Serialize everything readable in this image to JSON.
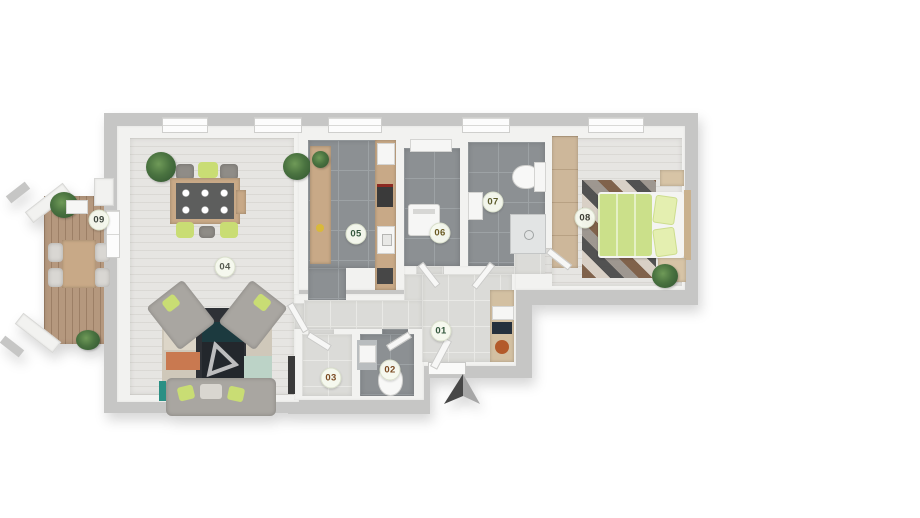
{
  "meta": {
    "type": "floor-plan",
    "description": "3D rendered apartment floor plan viewed from above with numbered room markers"
  },
  "palette": {
    "exterior_wall": "#c6c6c5",
    "interior_wall": "#f2f2f0",
    "dark_tile": "#8c9093",
    "light_tile": "#dbdbd8",
    "light_wood": "#e6e5e2",
    "deck_wood": "#b5987e",
    "accent_lime": "#c9dd74",
    "bed_green": "#cbe08a",
    "badge_bg": "#f6f9ee"
  },
  "rooms": [
    {
      "id": "01",
      "label": "01",
      "label_color": "#33573d"
    },
    {
      "id": "02",
      "label": "02",
      "label_color": "#7a4a22"
    },
    {
      "id": "03",
      "label": "03",
      "label_color": "#7a4a22"
    },
    {
      "id": "04",
      "label": "04",
      "label_color": "#555a50"
    },
    {
      "id": "05",
      "label": "05",
      "label_color": "#33573d"
    },
    {
      "id": "06",
      "label": "06",
      "label_color": "#6a5a22"
    },
    {
      "id": "07",
      "label": "07",
      "label_color": "#5a5a2a"
    },
    {
      "id": "08",
      "label": "08",
      "label_color": "#3c3c34"
    },
    {
      "id": "09",
      "label": "09",
      "label_color": "#3c443c"
    }
  ],
  "icons": {
    "north_arrow": "north-arrow",
    "watermark": "triangle-watermark"
  }
}
